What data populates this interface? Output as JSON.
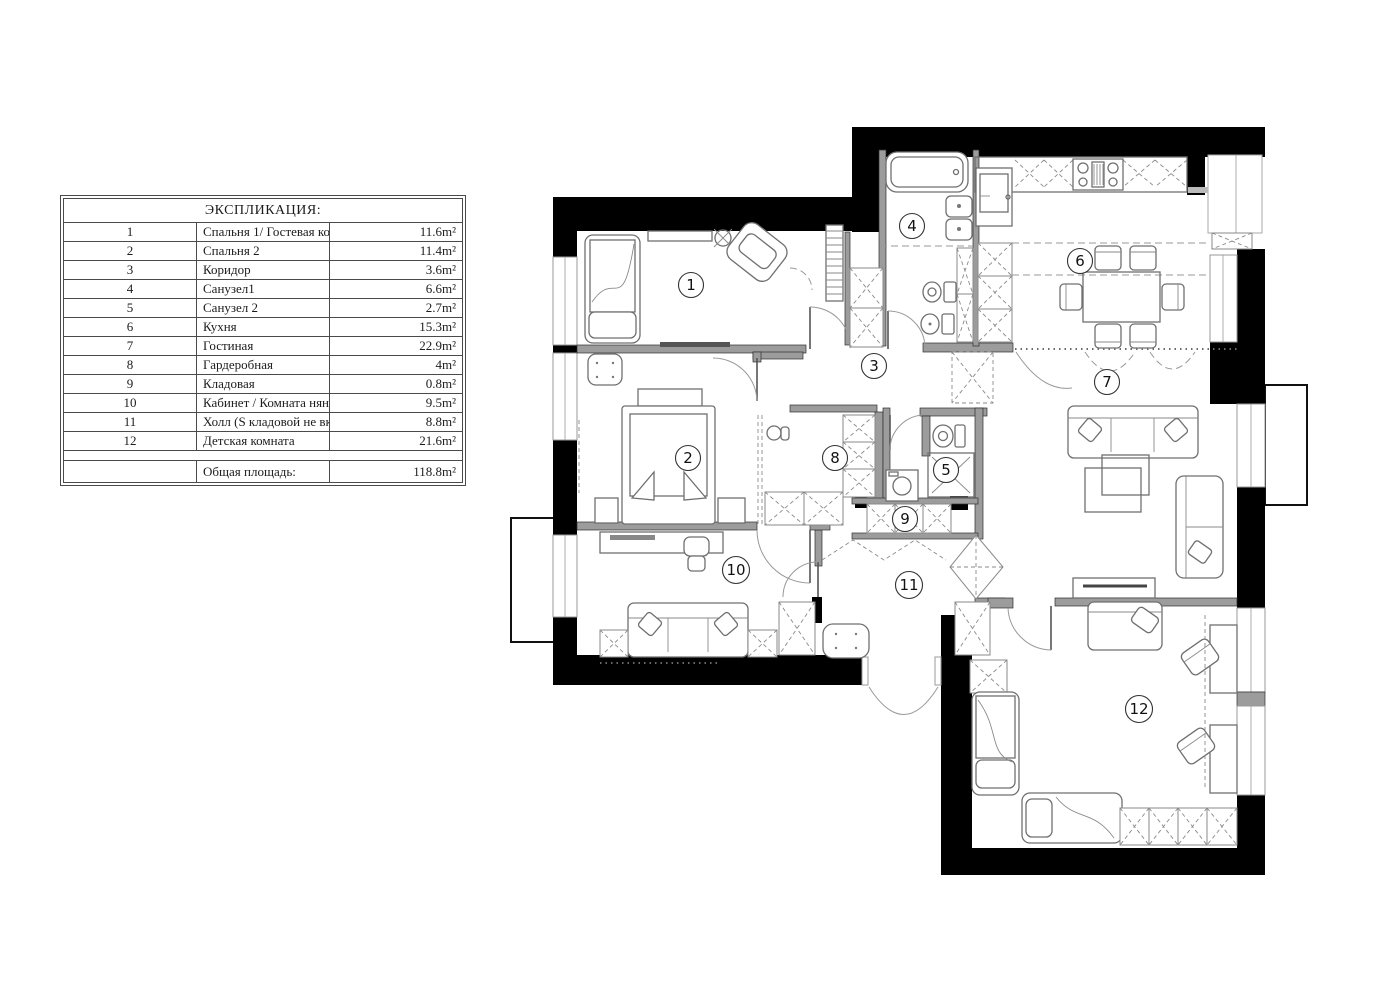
{
  "legend": {
    "title": "ЭКСПЛИКАЦИЯ:",
    "rows": [
      {
        "num": "1",
        "name": "Спальня 1/ Гостевая комната",
        "area": "11.6m²"
      },
      {
        "num": "2",
        "name": "Спальня 2",
        "area": "11.4m²"
      },
      {
        "num": "3",
        "name": "Коридор",
        "area": "3.6m²"
      },
      {
        "num": "4",
        "name": "Санузел1",
        "area": "6.6m²"
      },
      {
        "num": "5",
        "name": "Санузел 2",
        "area": "2.7m²"
      },
      {
        "num": "6",
        "name": "Кухня",
        "area": "15.3m²"
      },
      {
        "num": "7",
        "name": "Гостиная",
        "area": "22.9m²"
      },
      {
        "num": "8",
        "name": "Гардеробная",
        "area": "4m²"
      },
      {
        "num": "9",
        "name": "Кладовая",
        "area": "0.8m²"
      },
      {
        "num": "10",
        "name": "Кабинет / Комната няни",
        "area": "9.5m²"
      },
      {
        "num": "11",
        "name": "Холл (S кладовой не включена)",
        "area": "8.8m²"
      },
      {
        "num": "12",
        "name": "Детская комната",
        "area": "21.6m²"
      }
    ],
    "total_label": "Общая площадь:",
    "total_area": "118.8m²"
  },
  "plan": {
    "colors": {
      "wall": "#000000",
      "background": "#ffffff"
    },
    "room_labels": [
      {
        "number": "1"
      },
      {
        "number": "2"
      },
      {
        "number": "3"
      },
      {
        "number": "4"
      },
      {
        "number": "5"
      },
      {
        "number": "6"
      },
      {
        "number": "7"
      },
      {
        "number": "8"
      },
      {
        "number": "9"
      },
      {
        "number": "10"
      },
      {
        "number": "11"
      },
      {
        "number": "12"
      }
    ]
  }
}
